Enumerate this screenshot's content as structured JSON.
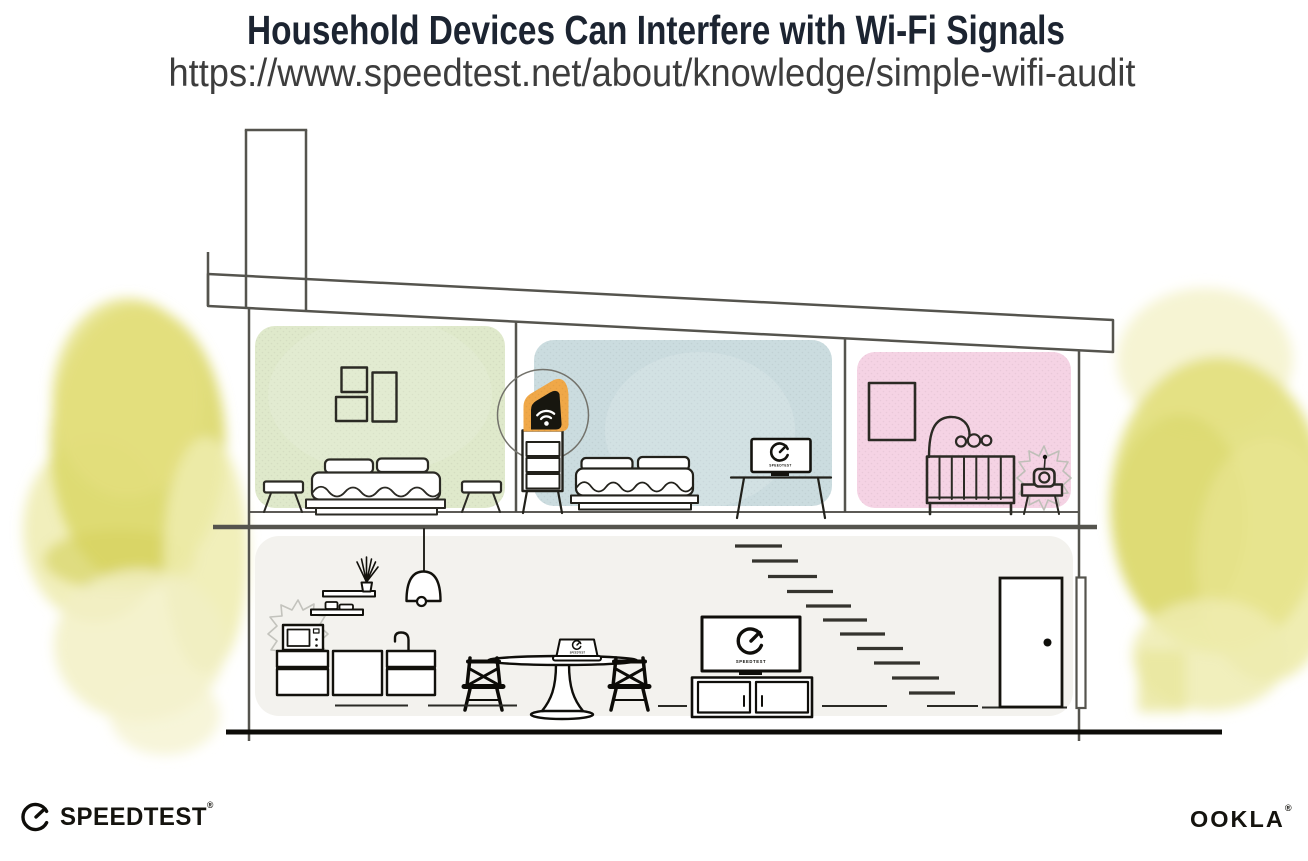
{
  "header": {
    "title": "Household Devices Can Interfere with Wi-Fi Signals",
    "url": "https://www.speedtest.net/about/knowledge/simple-wifi-audit"
  },
  "illustration": {
    "screen_brand_label": "SPEEDTEST",
    "highlighted_device": "wifi-router",
    "interference_devices": [
      "microwave",
      "baby-monitor"
    ],
    "colors": {
      "bedroom_green_wall": "#dfe9cb",
      "bedroom_blue_wall": "#cbdcdf",
      "nursery_pink_wall": "#f5d3e4",
      "ground_floor_fill": "#f3f2ee",
      "router_highlight_orange": "#f0a848",
      "foliage_yellow": "#e0dd76",
      "structure_gray": "#55544e",
      "ink_black": "#14130e"
    }
  },
  "footer": {
    "speedtest_label": "SPEEDTEST",
    "ookla_label": "OOKLA",
    "trademark": "®"
  }
}
